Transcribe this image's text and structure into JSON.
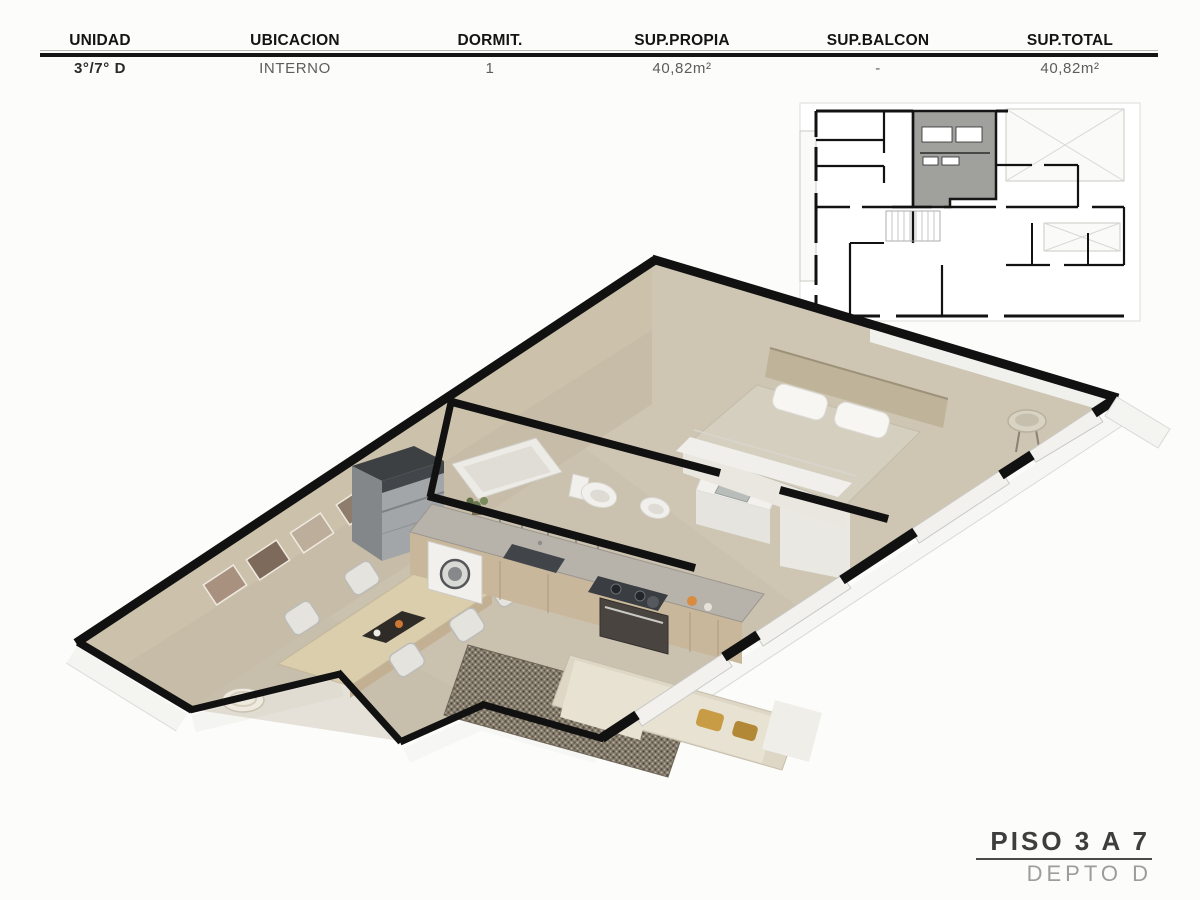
{
  "table": {
    "headers": [
      "UNIDAD",
      "UBICACION",
      "DORMIT.",
      "SUP.PROPIA",
      "SUP.BALCON",
      "SUP.TOTAL"
    ],
    "values": [
      "3°/7° D",
      "INTERNO",
      "1",
      "40,82m²",
      "-",
      "40,82m²"
    ]
  },
  "footer": {
    "piso": "PISO 3 A 7",
    "depto": "DEPTO D"
  },
  "colors": {
    "wall_black": "#111111",
    "floor_beige": "#cac1af",
    "wall_face_beige": "#c5bba6",
    "keyplan_highlight_gray": "#a0a09c",
    "wood_accent": "#c9b79b",
    "page_background": "#fcfcfb"
  }
}
